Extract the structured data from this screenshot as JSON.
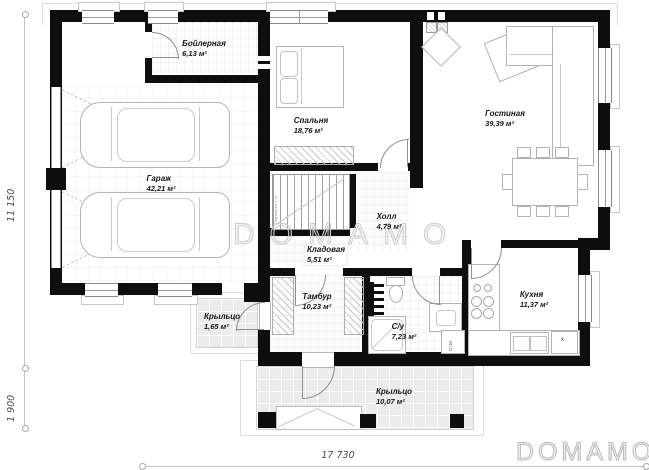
{
  "watermark": "DOMAMO",
  "logo": "DOMAMO",
  "dimensions": {
    "left_upper": "11 150",
    "left_lower": "1 900",
    "bottom": "17 730"
  },
  "rooms": {
    "boiler": {
      "name": "Бойлерная",
      "area": "6,13 м²"
    },
    "garage": {
      "name": "Гараж",
      "area": "42,21 м²"
    },
    "bedroom": {
      "name": "Спальня",
      "area": "18,76 м²"
    },
    "living": {
      "name": "Гостиная",
      "area": "39,39 м²"
    },
    "hall": {
      "name": "Холл",
      "area": "4,79 м²"
    },
    "storage": {
      "name": "Кладовая",
      "area": "5,51 м²"
    },
    "tambour": {
      "name": "Тамбур",
      "area": "10,23 м²"
    },
    "bathroom": {
      "name": "С/у",
      "area": "7,23 м²"
    },
    "kitchen": {
      "name": "Кухня",
      "area": "11,37 м²"
    },
    "porch_small": {
      "name": "Крыльцо",
      "area": "1,65 м²"
    },
    "porch_main": {
      "name": "Крыльцо",
      "area": "10,07 м²"
    }
  },
  "annotations": {
    "washer": "Ст.М",
    "fridge": "x",
    "stair_note": "Подъем на 2 эт."
  },
  "colors": {
    "wall": "#0e0e0e",
    "furniture_line": "#b3b3b3",
    "porch_fill": "#ebebeb",
    "watermark_stroke": "#cdcdcd"
  }
}
